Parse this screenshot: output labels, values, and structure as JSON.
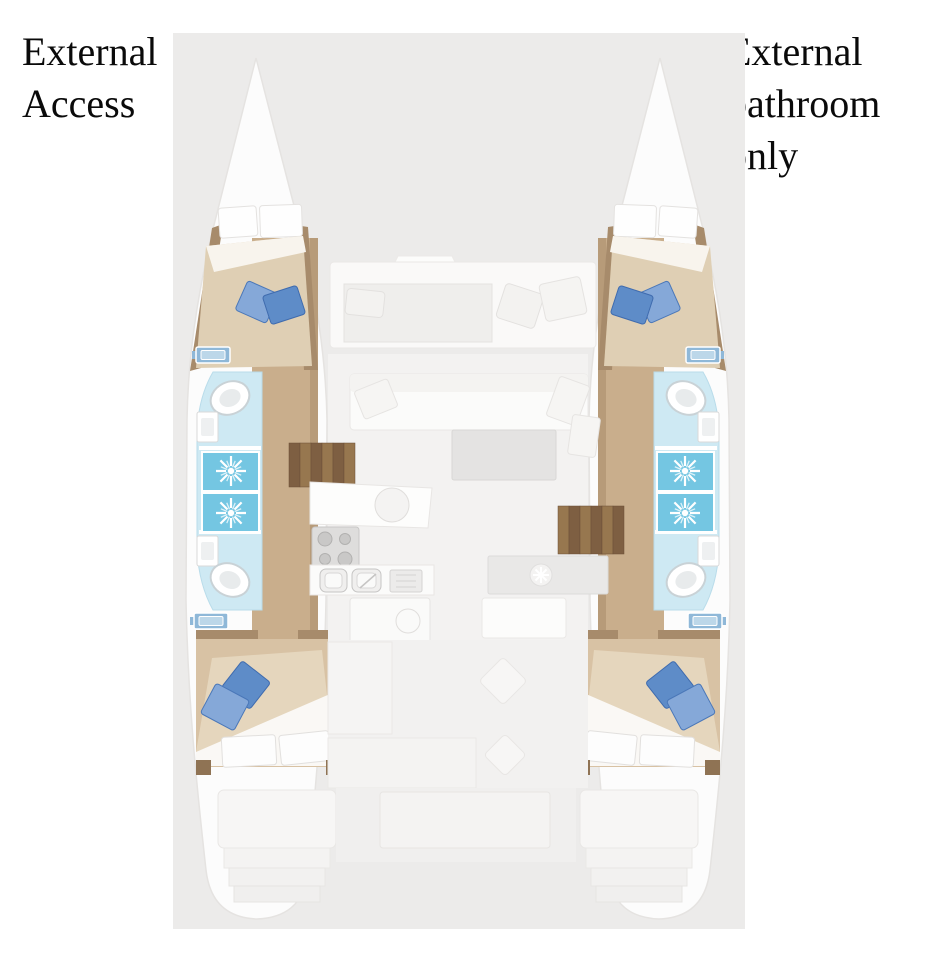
{
  "annotations": {
    "left": {
      "lines": [
        "External",
        "Access"
      ]
    },
    "right": {
      "lines": [
        "External",
        "bathroom",
        "only"
      ]
    }
  },
  "floorplan": {
    "type": "catamaran-yacht-deck-plan",
    "features": {
      "cabins": [
        "forward-port-cabin",
        "aft-port-cabin",
        "forward-starboard-cabin",
        "aft-starboard-cabin"
      ],
      "bathrooms_count": 4,
      "showers_count": 4,
      "toilets_count": 4,
      "areas": [
        "foredeck-seating",
        "salon",
        "salon-table",
        "galley",
        "stove",
        "port-stairs",
        "starboard-stairs",
        "cockpit",
        "transom-steps"
      ]
    },
    "colors": {
      "plan_background": "#ECEBEA",
      "hull": "#FCFCFC",
      "wood_trim": "#A78B6B",
      "walkway_wood": "#C9AE8C",
      "stairs_wood": "#7E5F42",
      "mattress": "#DFCFB4",
      "bathroom_floor": "#CEE9F3",
      "shower_blue": "#74C6E2",
      "pillow_blue_light": "#85A8D8",
      "pillow_blue_dark": "#5E8CC8",
      "text": "#0A0A0A"
    }
  }
}
